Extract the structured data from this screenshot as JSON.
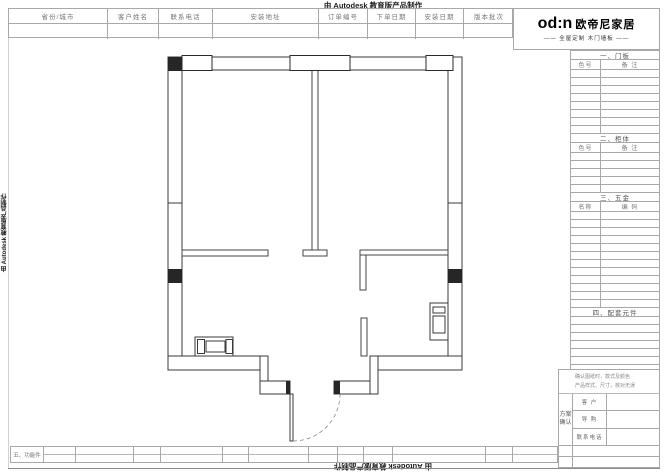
{
  "watermarks": {
    "top": "由 Autodesk 教育版产品制作",
    "bottom": "由 Autodesk 教育版产品制作",
    "left": "由 Autodesk 教育版产品制作"
  },
  "header_fields": [
    {
      "label": "省份/城市",
      "value": ""
    },
    {
      "label": "客户姓名",
      "value": ""
    },
    {
      "label": "联系电话",
      "value": ""
    },
    {
      "label": "安装地址",
      "value": ""
    },
    {
      "label": "订单编号",
      "value": ""
    },
    {
      "label": "下单日期",
      "value": ""
    },
    {
      "label": "安装日期",
      "value": ""
    },
    {
      "label": "版本批次",
      "value": ""
    }
  ],
  "brand": {
    "logo": "od:n",
    "name": "欧帝尼家居",
    "tagline": "—— 全屋定制 木门墙板 ——"
  },
  "sidebar_sections": [
    {
      "title": "一、门板",
      "columns": [
        "色号",
        "备 注"
      ],
      "empty_rows": 8
    },
    {
      "title": "二、柜体",
      "columns": [
        "色号",
        "备 注"
      ],
      "empty_rows": 5
    },
    {
      "title": "三、五金",
      "columns": [
        "名称",
        "编 码"
      ],
      "empty_rows": 12
    },
    {
      "title": "四、配套元件",
      "columns": null,
      "empty_rows": 7
    }
  ],
  "confirm": {
    "note_lines": [
      "确认图纸时，款式及颜色",
      "产品样式、尺寸，核对无误"
    ],
    "block_label": "方案确认",
    "rows": [
      {
        "label": "客 户",
        "value": ""
      },
      {
        "label": "导 购",
        "value": ""
      },
      {
        "label": "联系电话",
        "value": ""
      }
    ]
  },
  "bottom_row_label": "五、功能件",
  "floor_plan": {
    "type": "residential floor plan, top view",
    "rooms": 2,
    "windows": 3,
    "entry": "bottom-center door with dashed swing arc",
    "fixtures": [
      "cabinet at bottom-left wall",
      "appliance on right wall"
    ]
  }
}
